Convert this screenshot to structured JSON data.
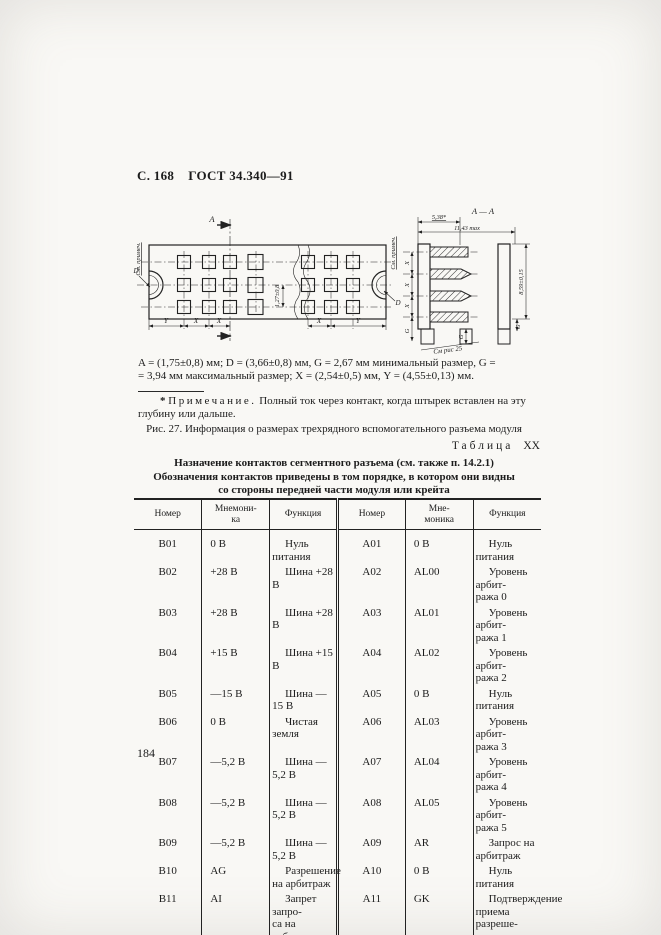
{
  "header": {
    "left": "С. 168",
    "right": "ГОСТ 34.340—91"
  },
  "figure": {
    "labels": {
      "section": "A",
      "section_view": "А — А",
      "see_note": "См. примеч.",
      "hole_d": "D",
      "pitch": "1,27±0,8",
      "x": "X",
      "y": "Y",
      "g": "G",
      "depth": "5,38*",
      "max_width": "11,43 max",
      "height": "8,59±0,15",
      "see_fig": "См рис 25"
    },
    "dimensions_text": "A = (1,75±0,8) мм; D = (3,66±0,8) мм, G = 2,67 мм минимальный размер, G =\n= 3,94 мм максимальный размер; X = (2,54±0,5) мм, Y = (4,55±0,13) мм.",
    "note_star": "*",
    "note_label": "Примечание.",
    "note_text": "Полный ток через контакт, когда штырек вставлен на эту глубину или дальше.",
    "caption": "Рис. 27. Информация о размерах трехрядного вспомогательного разъема модуля"
  },
  "table": {
    "label_word": "Таблица",
    "label_number": "XX",
    "title_lines": [
      "Назначение контактов сегментного разъема (см. также п. 14.2.1)",
      "Обозначения контактов приведены в том порядке, в котором они видны",
      "со стороны передней части модуля или крейта"
    ],
    "headers": [
      "Номер",
      "Мнемони-\nка",
      "Функция",
      "Номер",
      "Мне-\nмоника",
      "Функция"
    ],
    "rows": [
      [
        "B01",
        "0 В",
        "Нуль питания",
        "A01",
        "0 В",
        "Нуль питания"
      ],
      [
        "B02",
        "+28 В",
        "Шина +28 В",
        "A02",
        "AL00",
        "Уровень арбит-\nража 0"
      ],
      [
        "B03",
        "+28 В",
        "Шина +28 В",
        "A03",
        "AL01",
        "Уровень арбит-\nража 1"
      ],
      [
        "B04",
        "+15 В",
        "Шина +15 В",
        "A04",
        "AL02",
        "Уровень арбит-\nража 2"
      ],
      [
        "B05",
        "—15 В",
        "Шина —15 В",
        "A05",
        "0 В",
        "Нуль питания"
      ],
      [
        "B06",
        "0 В",
        "Чистая земля",
        "A06",
        "AL03",
        "Уровень арбит-\nража 3"
      ],
      [
        "B07",
        "—5,2 В",
        "Шина —5,2 В",
        "A07",
        "AL04",
        "Уровень арбит-\nража 4"
      ],
      [
        "B08",
        "—5,2 В",
        "Шина —5,2 В",
        "A08",
        "AL05",
        "Уровень арбит-\nража 5"
      ],
      [
        "B09",
        "—5,2 В",
        "Шина —5,2 В",
        "A09",
        "AR",
        "Запрос на\nарбитраж"
      ],
      [
        "B10",
        "AG",
        "Разрешение\nна арбитраж",
        "A10",
        "0 В",
        "Нуль питания"
      ],
      [
        "B11",
        "AI",
        "Запрет запро-\nса на арбитраж",
        "A11",
        "GK",
        "Подтверждение\nприема разреше-\nния на арбитраж"
      ]
    ]
  },
  "page_number": "184"
}
